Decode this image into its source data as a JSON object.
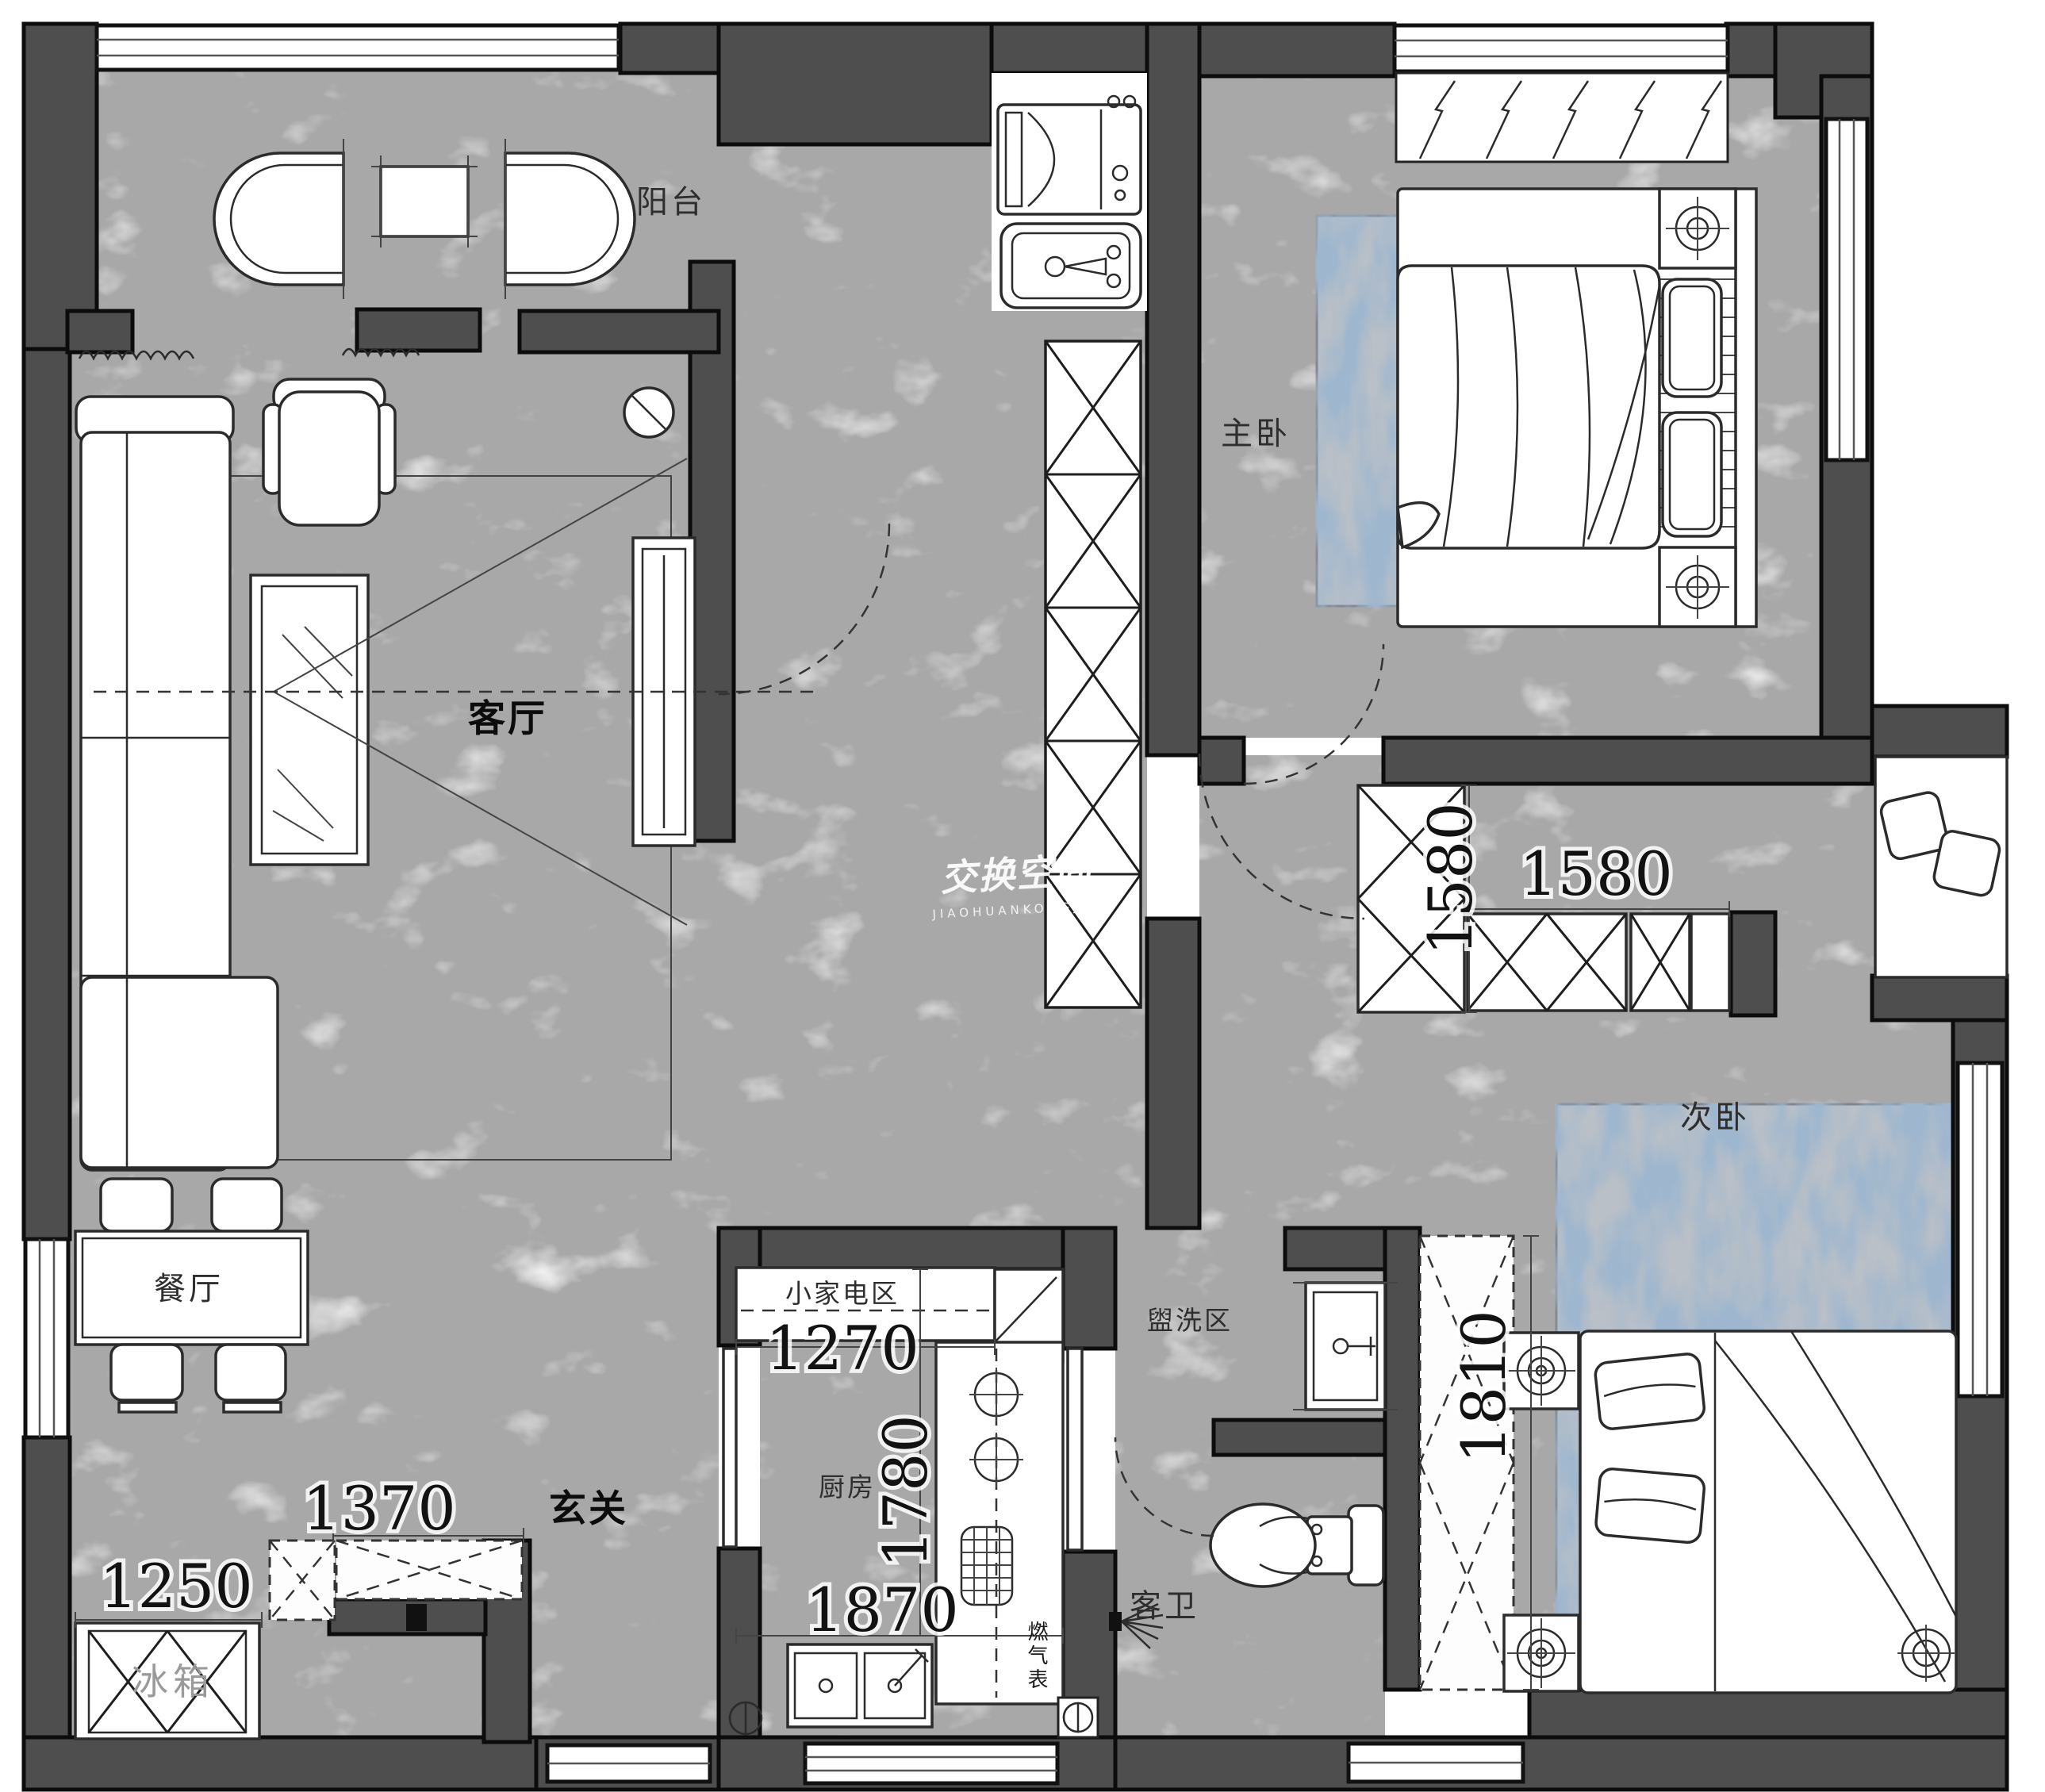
{
  "watermark": {
    "text": "交换空间",
    "subtext": "JIAOHUANKONGJIAN"
  },
  "labels": {
    "balcony": "阳台",
    "master_bedroom": "主卧",
    "living_room": "客厅",
    "dining_room": "餐厅",
    "foyer": "玄关",
    "kitchen": "厨房",
    "guest_bathroom": "客卫",
    "washing_area": "盥洗区",
    "second_bedroom": "次卧",
    "small_appliance_area": "小家电区",
    "fridge": "冰箱",
    "gas_meter": "燃气表"
  },
  "dimensions": {
    "small_appliance_width": "1270",
    "kitchen_counter_depth": "1780",
    "kitchen_width": "1870",
    "foyer_cabinet_width": "1370",
    "foyer_width": "1250",
    "wardrobe_row_width": "1580",
    "wardrobe_column_depth": "1580",
    "closet_depth": "1810"
  },
  "colors": {
    "wall": "#4e4e4e",
    "floor_marble": "#a8a8a8",
    "rug_base": "#b9c0c8",
    "rug_accent": "#5d7da1",
    "outline": "#2b2b2b"
  }
}
